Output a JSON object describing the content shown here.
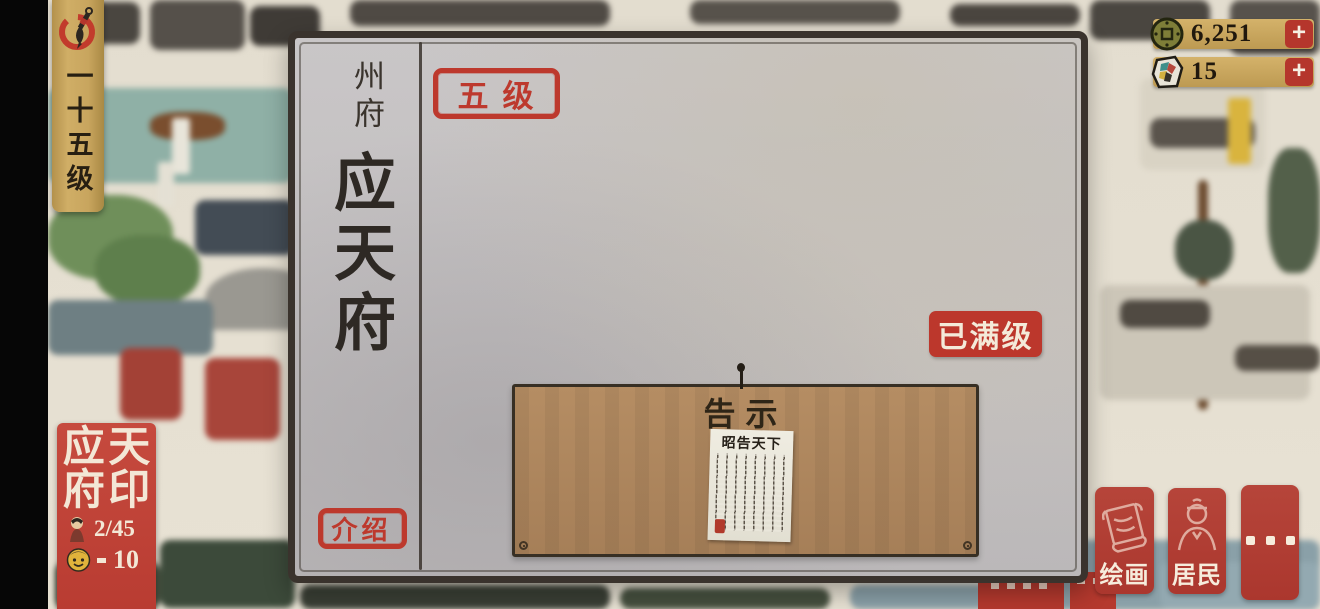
{
  "hud": {
    "level_banner": {
      "icon": "ink-brush-icon",
      "text": "一十五级"
    },
    "currencies": [
      {
        "icon": "copper-coin-icon",
        "value": "6,251",
        "plus": "+"
      },
      {
        "icon": "painting-stone-icon",
        "value": "15",
        "plus": "+"
      }
    ],
    "city_seal": {
      "chars": [
        "应",
        "天",
        "府",
        "印"
      ],
      "residents_icon": "villager-icon",
      "residents_count": "2/45",
      "happiness_icon": "smiley-face-icon",
      "happiness_count": "10"
    },
    "actions": [
      {
        "icon": "scroll-painting-icon",
        "label": "绘画"
      },
      {
        "icon": "resident-person-icon",
        "label": "居民"
      },
      {
        "icon": "more-dots",
        "label": "···"
      }
    ]
  },
  "panel": {
    "category": "州府",
    "title": "应天府",
    "level_badge": "五级",
    "max_level_badge": "已满级",
    "intro_button": "介绍",
    "board": {
      "title": "告示",
      "paper_title": "昭告天下"
    }
  },
  "colors": {
    "accent_red": "#b5362c",
    "banner_gold": "#c8a55e",
    "board_brown": "#b0885f",
    "panel_paper": "#c7c4c5",
    "seal_red": "#bf4136",
    "ink": "#3a332d"
  }
}
